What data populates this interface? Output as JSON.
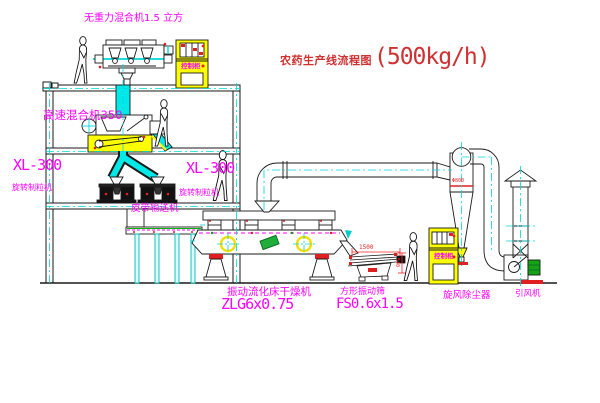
{
  "title": {
    "text": "农药生产线流程图",
    "capacity": "(500kg/h)"
  },
  "labels": {
    "gravity_mixer": "无重力混合机1.5 立方",
    "high_speed_mixer": "高速混合机350",
    "granulator_left": {
      "model": "XL-300",
      "name": "旋转制粒机"
    },
    "granulator_right": {
      "model": "XL-300",
      "name": "旋转制粒机"
    },
    "belt_conveyor": "皮带输送机",
    "fluid_bed_dryer": {
      "name": "振动流化床干燥机",
      "model": "ZLG6x0.75"
    },
    "square_sieve": {
      "name": "方形振动筛",
      "model": "FS0.6x1.5"
    },
    "cyclone": "旋风除尘器",
    "induced_draft_fan": "引风机",
    "control_cabinet_top": "控制柜",
    "control_cabinet_right": "控制柜"
  },
  "dimensions": {
    "sieve_width": "1500",
    "sieve_height": "540",
    "cyclone_note": "Φ800"
  },
  "colors": {
    "label_magenta": "#ff00ff",
    "title_red": "#d03030",
    "dimension_red": "#ff2020",
    "centerline_cyan": "#00d8d8",
    "highlight_yellow": "#ffff00",
    "machine_green": "#1fae3a",
    "line_black": "#1a1a1a"
  }
}
